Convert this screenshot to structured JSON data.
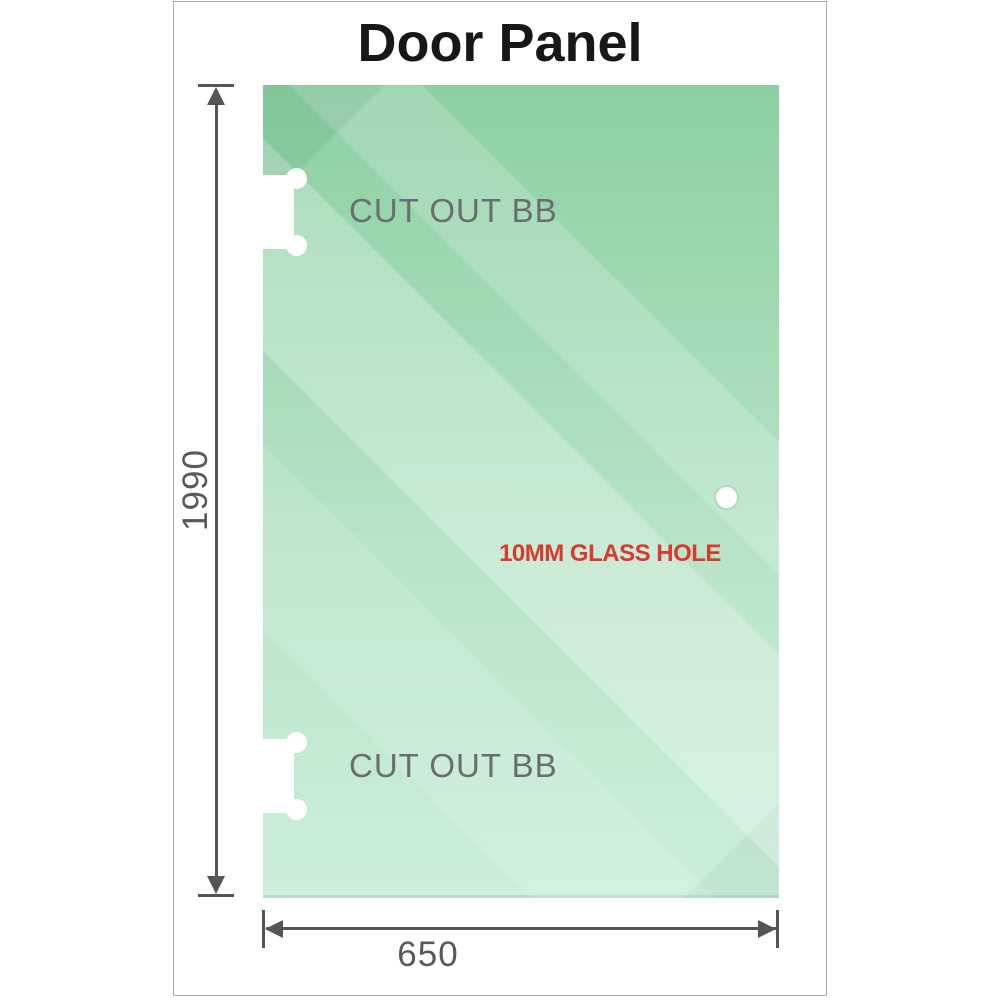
{
  "title": "Door Panel",
  "panel": {
    "cutout_top_label": "CUT OUT BB",
    "cutout_bottom_label": "CUT OUT BB",
    "glass_hole_label": "10MM GLASS HOLE"
  },
  "dimensions": {
    "height_mm": "1990",
    "width_mm": "650"
  },
  "colors": {
    "glass_top": "#8ccfa2",
    "glass_mid": "#b9e4c8",
    "glass_bottom": "#cceeda",
    "dimension_line": "#555555",
    "cutout_label": "#6a6e70",
    "glass_hole_label": "#d93a30",
    "title_color": "#171717",
    "frame_border": "#ababab"
  }
}
